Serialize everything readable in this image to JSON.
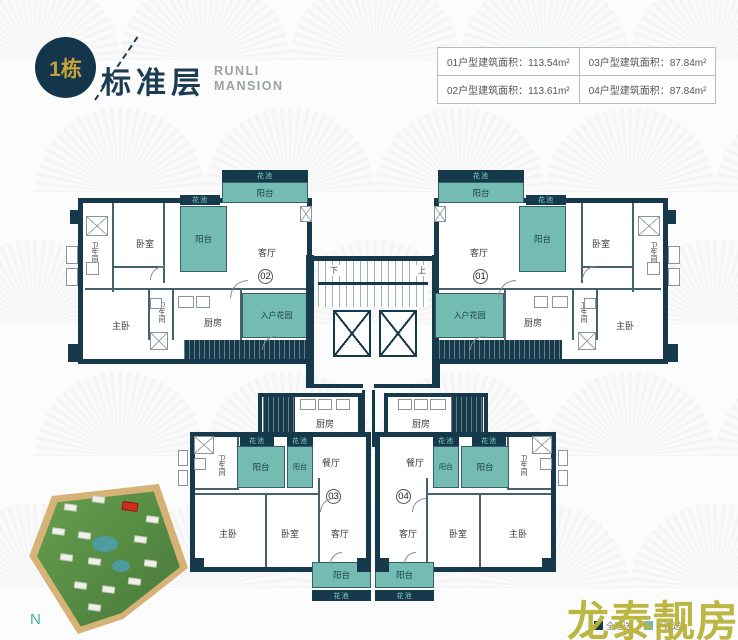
{
  "header": {
    "building_badge": "1栋",
    "title": "标准层",
    "brand_line1": "RUNLI",
    "brand_line2": "MANSION"
  },
  "area_table": {
    "cells": [
      [
        "01户型建筑面积：113.54m²",
        "03户型建筑面积：87.84m²"
      ],
      [
        "02户型建筑面积：113.61m²",
        "04户型建筑面积：87.84m²"
      ]
    ]
  },
  "rooms": {
    "balcony": "阳台",
    "flower_bed": "花池",
    "living_room": "客厅",
    "dining_room": "餐厅",
    "bedroom": "卧室",
    "master_bedroom": "主卧",
    "kitchen": "厨房",
    "bathroom": "卫生间",
    "entry_garden": "入户花园",
    "stairs_up": "上",
    "stairs_down": "下"
  },
  "units": {
    "u01": "01",
    "u02": "02",
    "u03": "03",
    "u04": "04"
  },
  "site_plan": {
    "north_label": "N"
  },
  "legend": [
    {
      "label": "全赠送",
      "color": "#17394c"
    },
    {
      "label": "半赠送",
      "color": "#74bcb1"
    }
  ],
  "watermark": {
    "text": "龙泰靓房"
  },
  "colors": {
    "wall_navy": "#17394c",
    "gift_teal": "#74bcb1",
    "accent_gold": "#c8a23c",
    "watermark_olive": "#b9b43a"
  }
}
